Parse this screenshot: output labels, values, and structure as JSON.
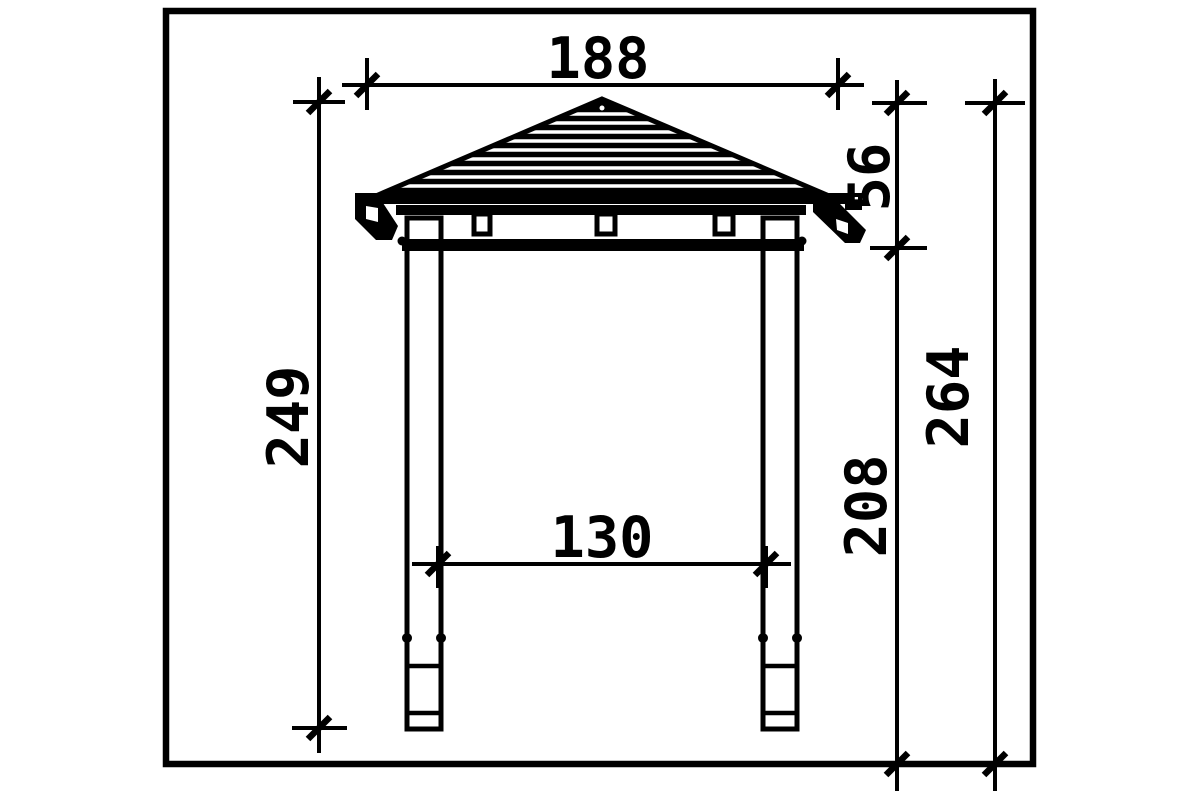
{
  "drawing": {
    "type": "technical dimension drawing",
    "subject": "gazebo side elevation with hip roof and two posts on ground anchors",
    "colors": {
      "line": "#000000",
      "background": "#ffffff"
    },
    "dimensions": {
      "roof_width": "188",
      "roof_height": "56",
      "height_ground_to_peak_left": "249",
      "clear_width_between_posts": "130",
      "post_height_to_beam": "208",
      "total_height": "264"
    }
  }
}
